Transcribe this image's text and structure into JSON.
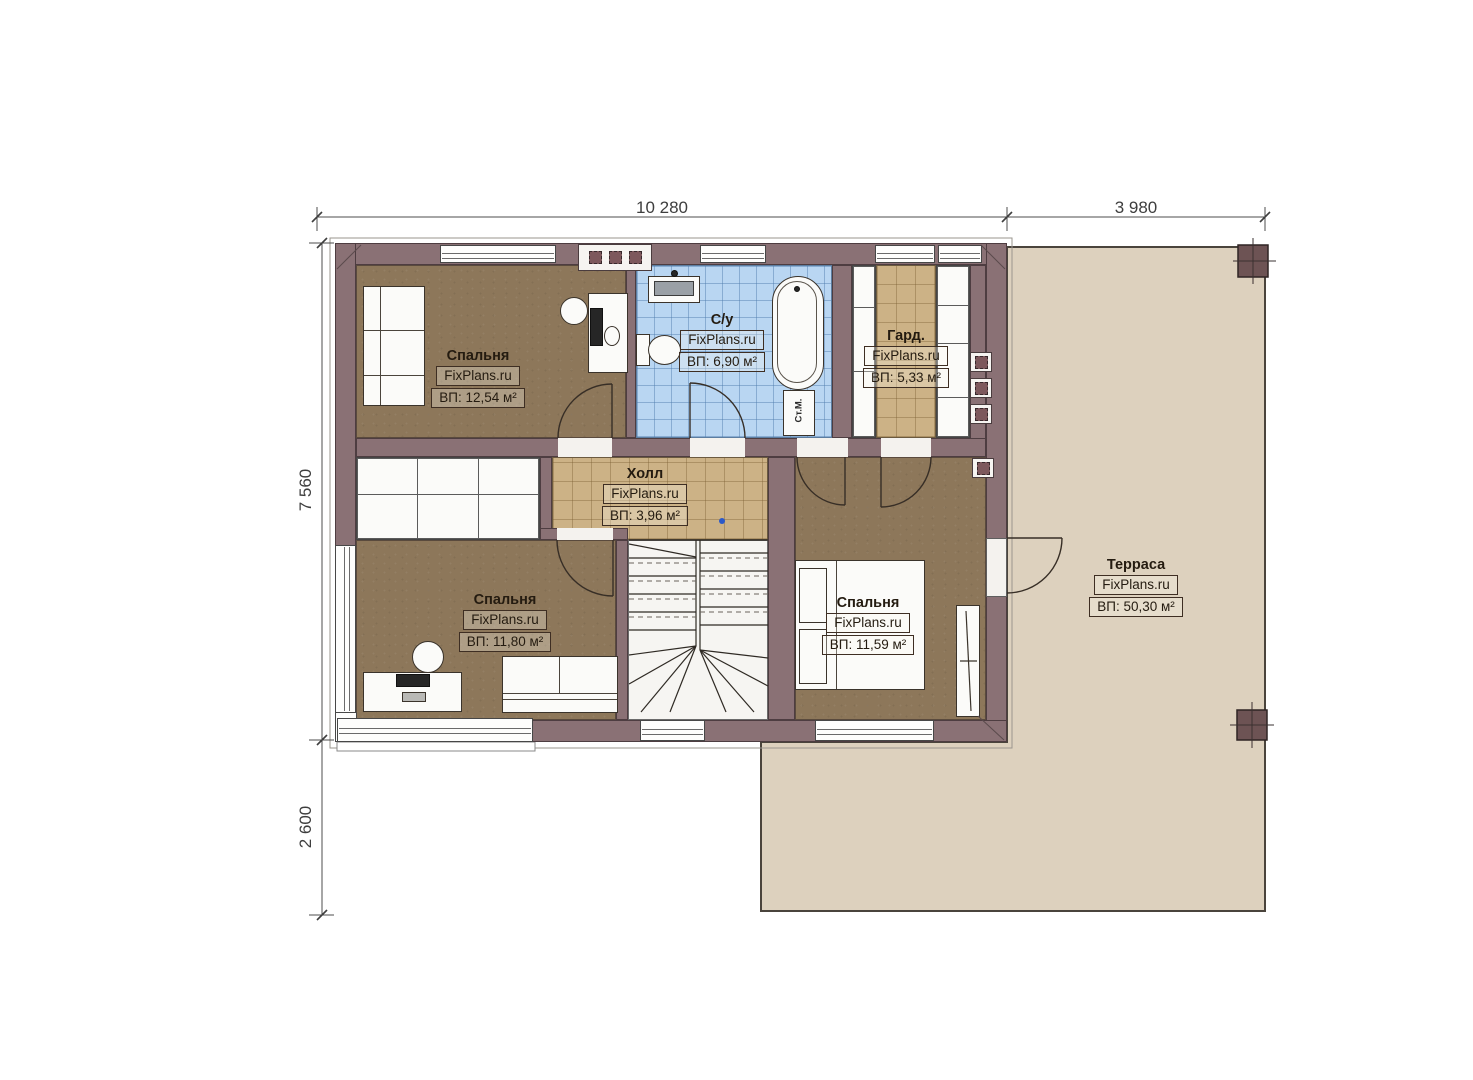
{
  "plan": {
    "title": "floor-plan",
    "dimensions": {
      "top": [
        {
          "label": "10 280"
        },
        {
          "label": "3 980"
        }
      ],
      "left": [
        {
          "label": "7 560"
        },
        {
          "label": "2 600"
        }
      ]
    },
    "rooms": [
      {
        "id": "bedroom-1",
        "name": "Спальня",
        "watermark": "FixPlans.ru",
        "area": "ВП: 12,54 м²"
      },
      {
        "id": "bathroom",
        "name": "С/у",
        "watermark": "FixPlans.ru",
        "area": "ВП: 6,90 м²"
      },
      {
        "id": "wardrobe",
        "name": "Гард.",
        "watermark": "FixPlans.ru",
        "area": "ВП: 5,33 м²"
      },
      {
        "id": "hall",
        "name": "Холл",
        "watermark": "FixPlans.ru",
        "area": "ВП: 3,96 м²"
      },
      {
        "id": "bedroom-2",
        "name": "Спальня",
        "watermark": "FixPlans.ru",
        "area": "ВП: 11,80 м²"
      },
      {
        "id": "bedroom-3",
        "name": "Спальня",
        "watermark": "FixPlans.ru",
        "area": "ВП: 11,59 м²"
      },
      {
        "id": "terrace",
        "name": "Терраса",
        "watermark": "FixPlans.ru",
        "area": "ВП: 50,30 м²"
      }
    ],
    "labels": {
      "washing_machine": "Ст.М."
    },
    "colors": {
      "wall": "#8a7175",
      "wood_floor": "#8d775a",
      "tan_tile": "#ccb286",
      "blue_tile": "#b9d6f2",
      "terrace": "#ddd1be"
    }
  }
}
